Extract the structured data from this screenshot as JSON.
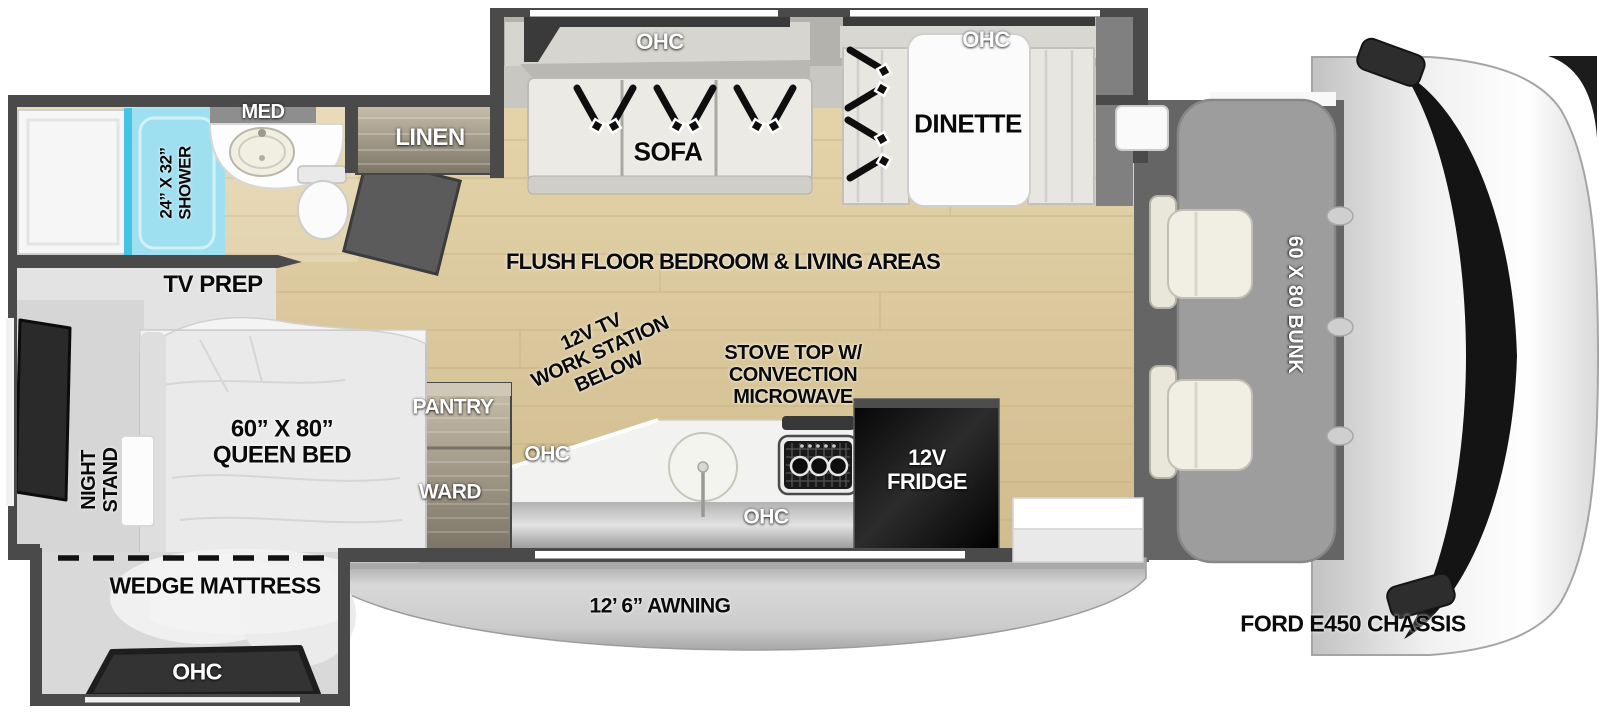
{
  "floorplan": {
    "chassis_label": "FORD E450 CHASSIS",
    "awning_label": "12’ 6” AWNING",
    "center_label": "FLUSH FLOOR BEDROOM & LIVING AREAS",
    "bunk_label": "60 X 80 BUNK",
    "bathroom": {
      "med": "MED",
      "shower_size": "24” X 32”",
      "shower_word": "SHOWER",
      "linen": "LINEN"
    },
    "living": {
      "ohc_sofa": "OHC",
      "sofa": "SOFA",
      "ohc_dinette": "OHC",
      "dinette": "DINETTE"
    },
    "kitchen": {
      "work_station": [
        "12V TV",
        "WORK STATION",
        "BELOW"
      ],
      "stove": [
        "STOVE TOP W/",
        "CONVECTION",
        "MICROWAVE"
      ],
      "pantry": "PANTRY",
      "ward": "WARD",
      "ohc_upper": "OHC",
      "ohc_lower": "OHC",
      "fridge": [
        "12V",
        "FRIDGE"
      ]
    },
    "bedroom": {
      "tv_prep": "TV PREP",
      "night_stand": [
        "NIGHT",
        "STAND"
      ],
      "queen_bed": [
        "60” X 80”",
        "QUEEN BED"
      ],
      "wedge": "WEDGE MATTRESS",
      "ohc": "OHC"
    },
    "colors": {
      "wall": "#4a4a4a",
      "floor_wood": "#dcc99e",
      "shower_blue": "#9edff0",
      "appliance_black": "#141414",
      "bunk_gray": "#9d9d9d"
    }
  }
}
